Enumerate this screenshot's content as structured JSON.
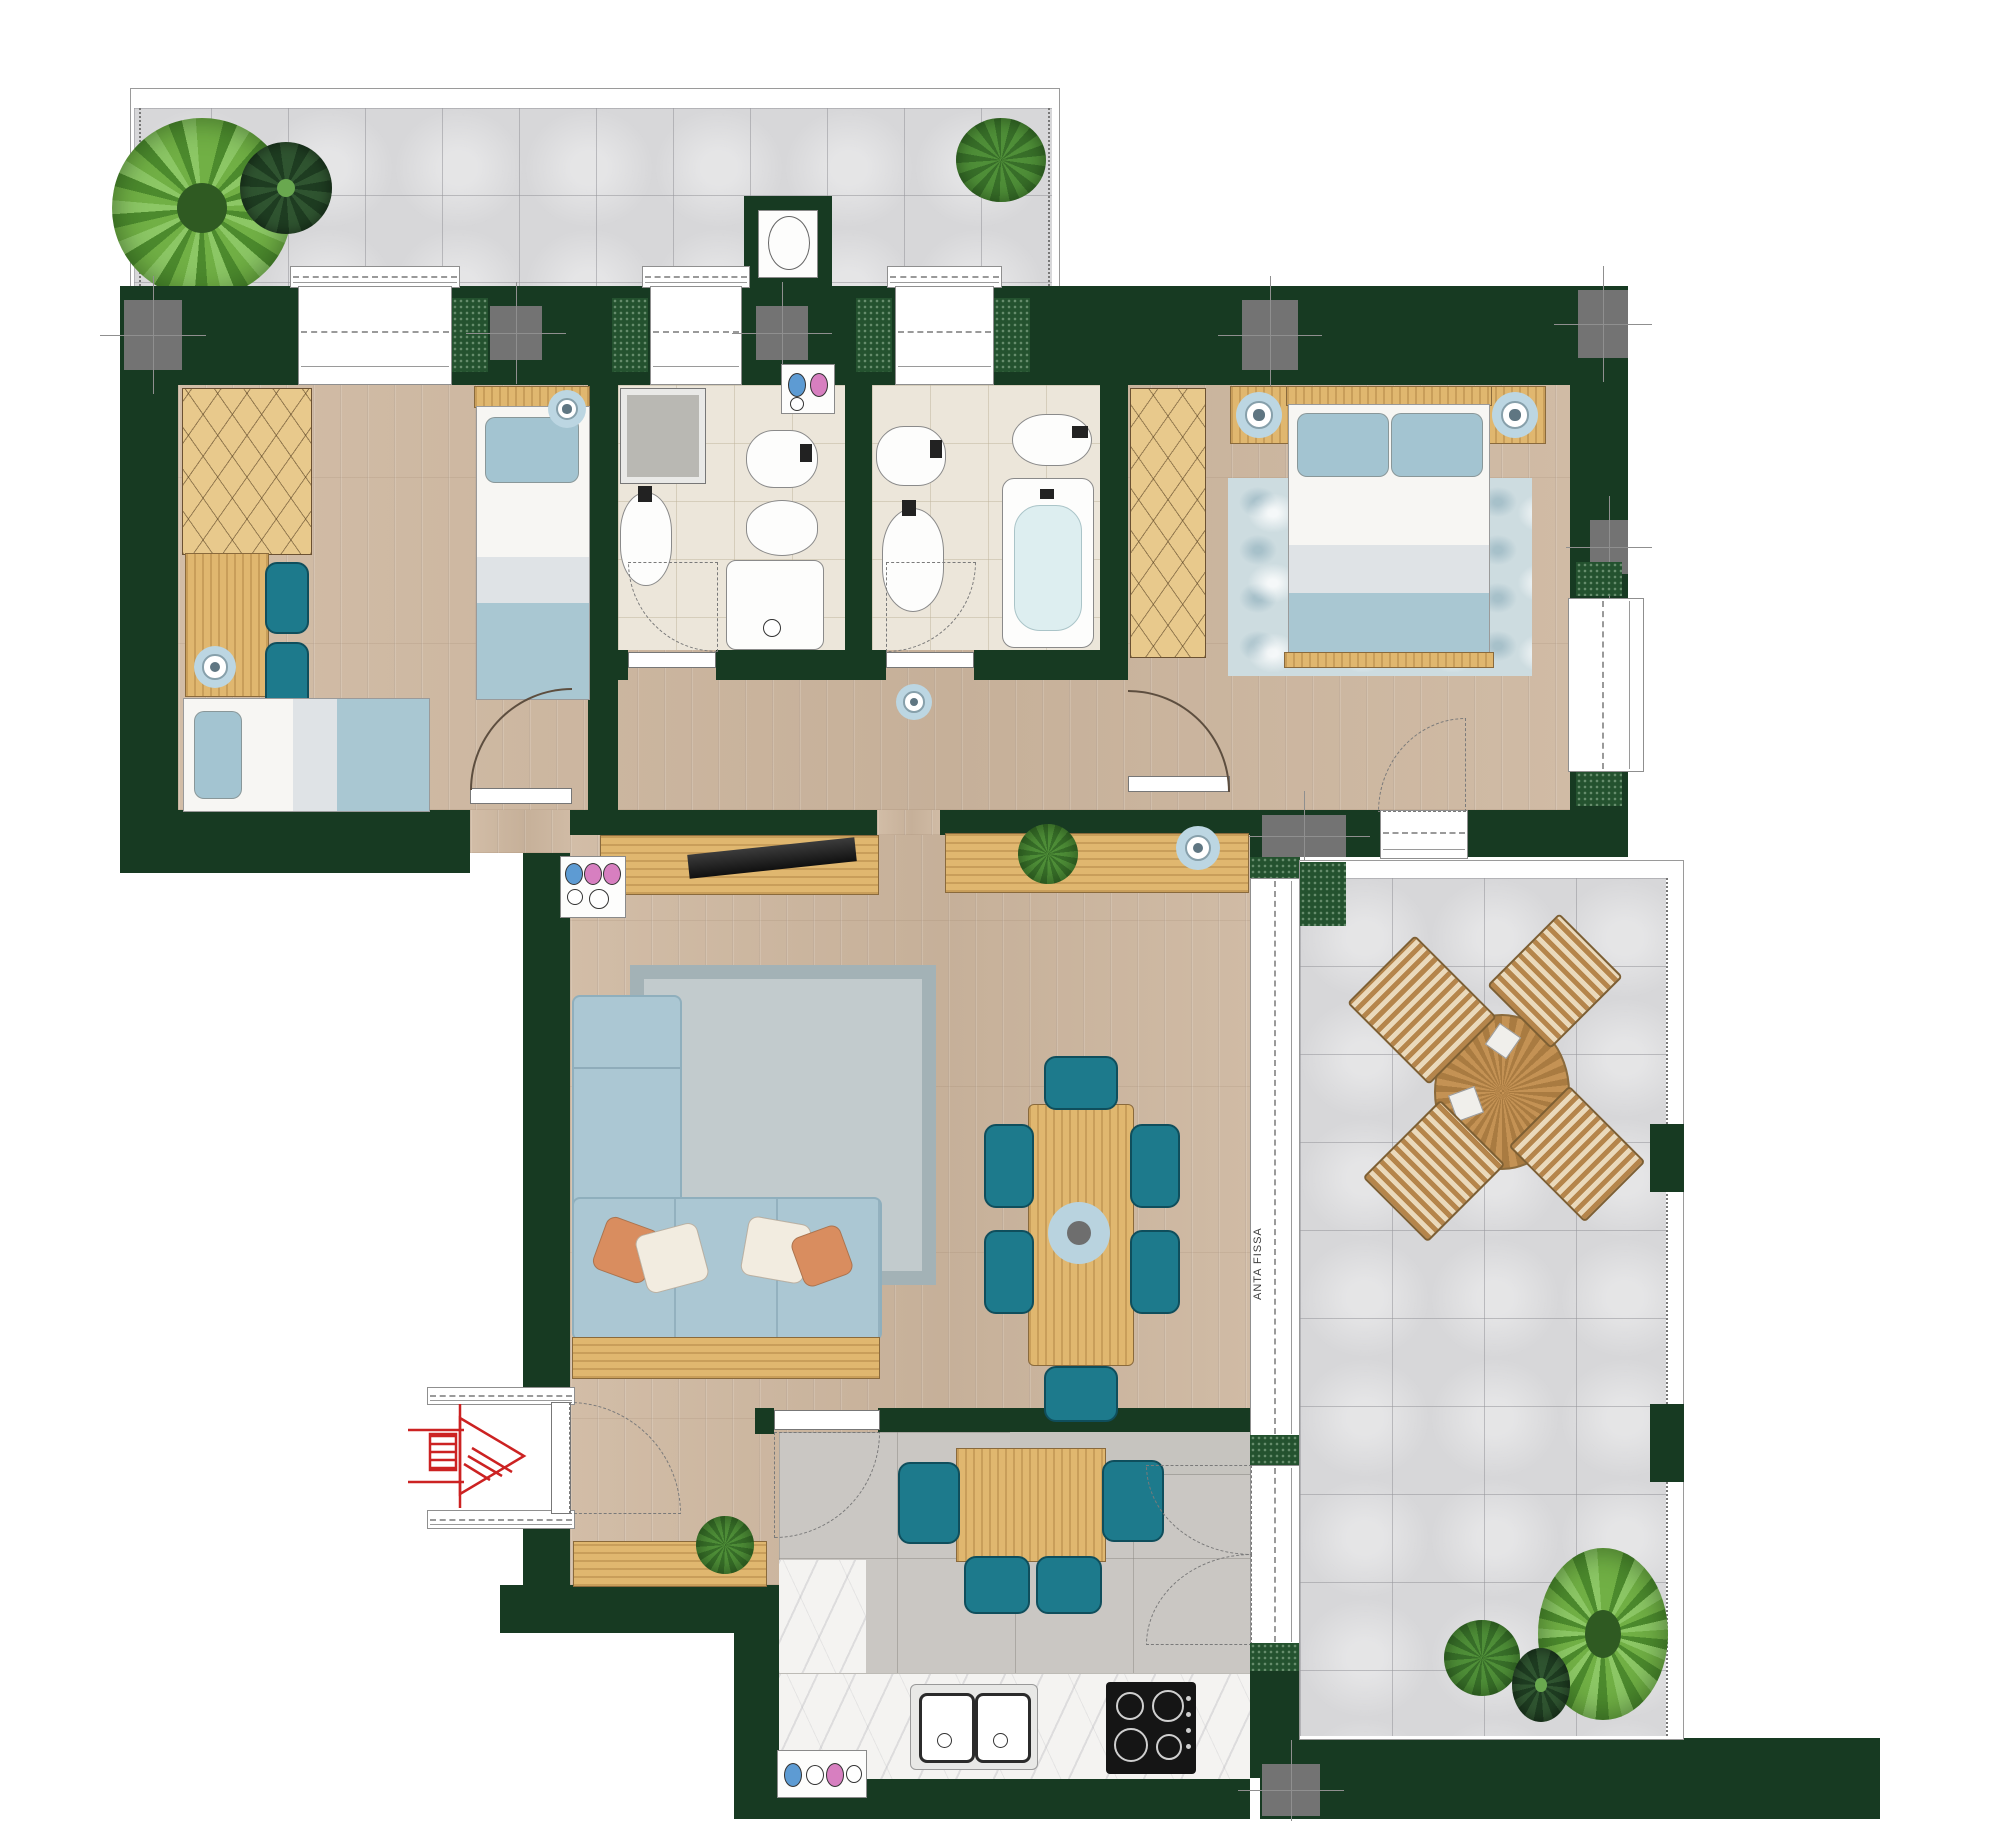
{
  "labels": {
    "anta_fissa": "ANTA FISSA"
  },
  "colors": {
    "wall_green": "#173a22",
    "hatch_green": "#24522f",
    "wood_floor": "#ccb7a1",
    "furniture_wood": "#e0b76f",
    "bath_floor": "#ece6da",
    "terrace_tile": "#d7d7d9",
    "kitchen_tile": "#cac7c3",
    "marble": "#f4f3f1",
    "sofa_blue": "#abc7d3",
    "bed_blue": "#a9c7d2",
    "chair_teal": "#1d7a8c",
    "rug_gray": "#c2cbcd",
    "rug_blue": "#cddce0",
    "lamp_ring": "#bcd6e2",
    "column_gray": "#737373",
    "plant_green": "#4f8f38",
    "entrance_red": "#cc2222",
    "cooktop_black": "#151515"
  },
  "icons": [
    "palm-plant-icon",
    "succulent-plant-icon",
    "bush-plant-icon",
    "vent-shaft-icon",
    "window-icon",
    "door-arc-icon",
    "column-icon",
    "ceiling-lamp-icon",
    "plumbing-symbol-icon",
    "wardrobe-icon",
    "desk-icon",
    "chair-icon",
    "single-bed-icon",
    "double-bed-icon",
    "nightstand-icon",
    "shower-icon",
    "shower-tray-icon",
    "washbasin-icon",
    "toilet-icon",
    "bidet-icon",
    "bathtub-icon",
    "sofa-icon",
    "tv-icon",
    "sideboard-icon",
    "dining-table-icon",
    "rug-icon",
    "kitchen-sink-icon",
    "cooktop-icon",
    "kitchen-table-icon",
    "outdoor-table-icon",
    "outdoor-chair-icon",
    "entrance-arrow-icon",
    "sliding-door-icon"
  ]
}
